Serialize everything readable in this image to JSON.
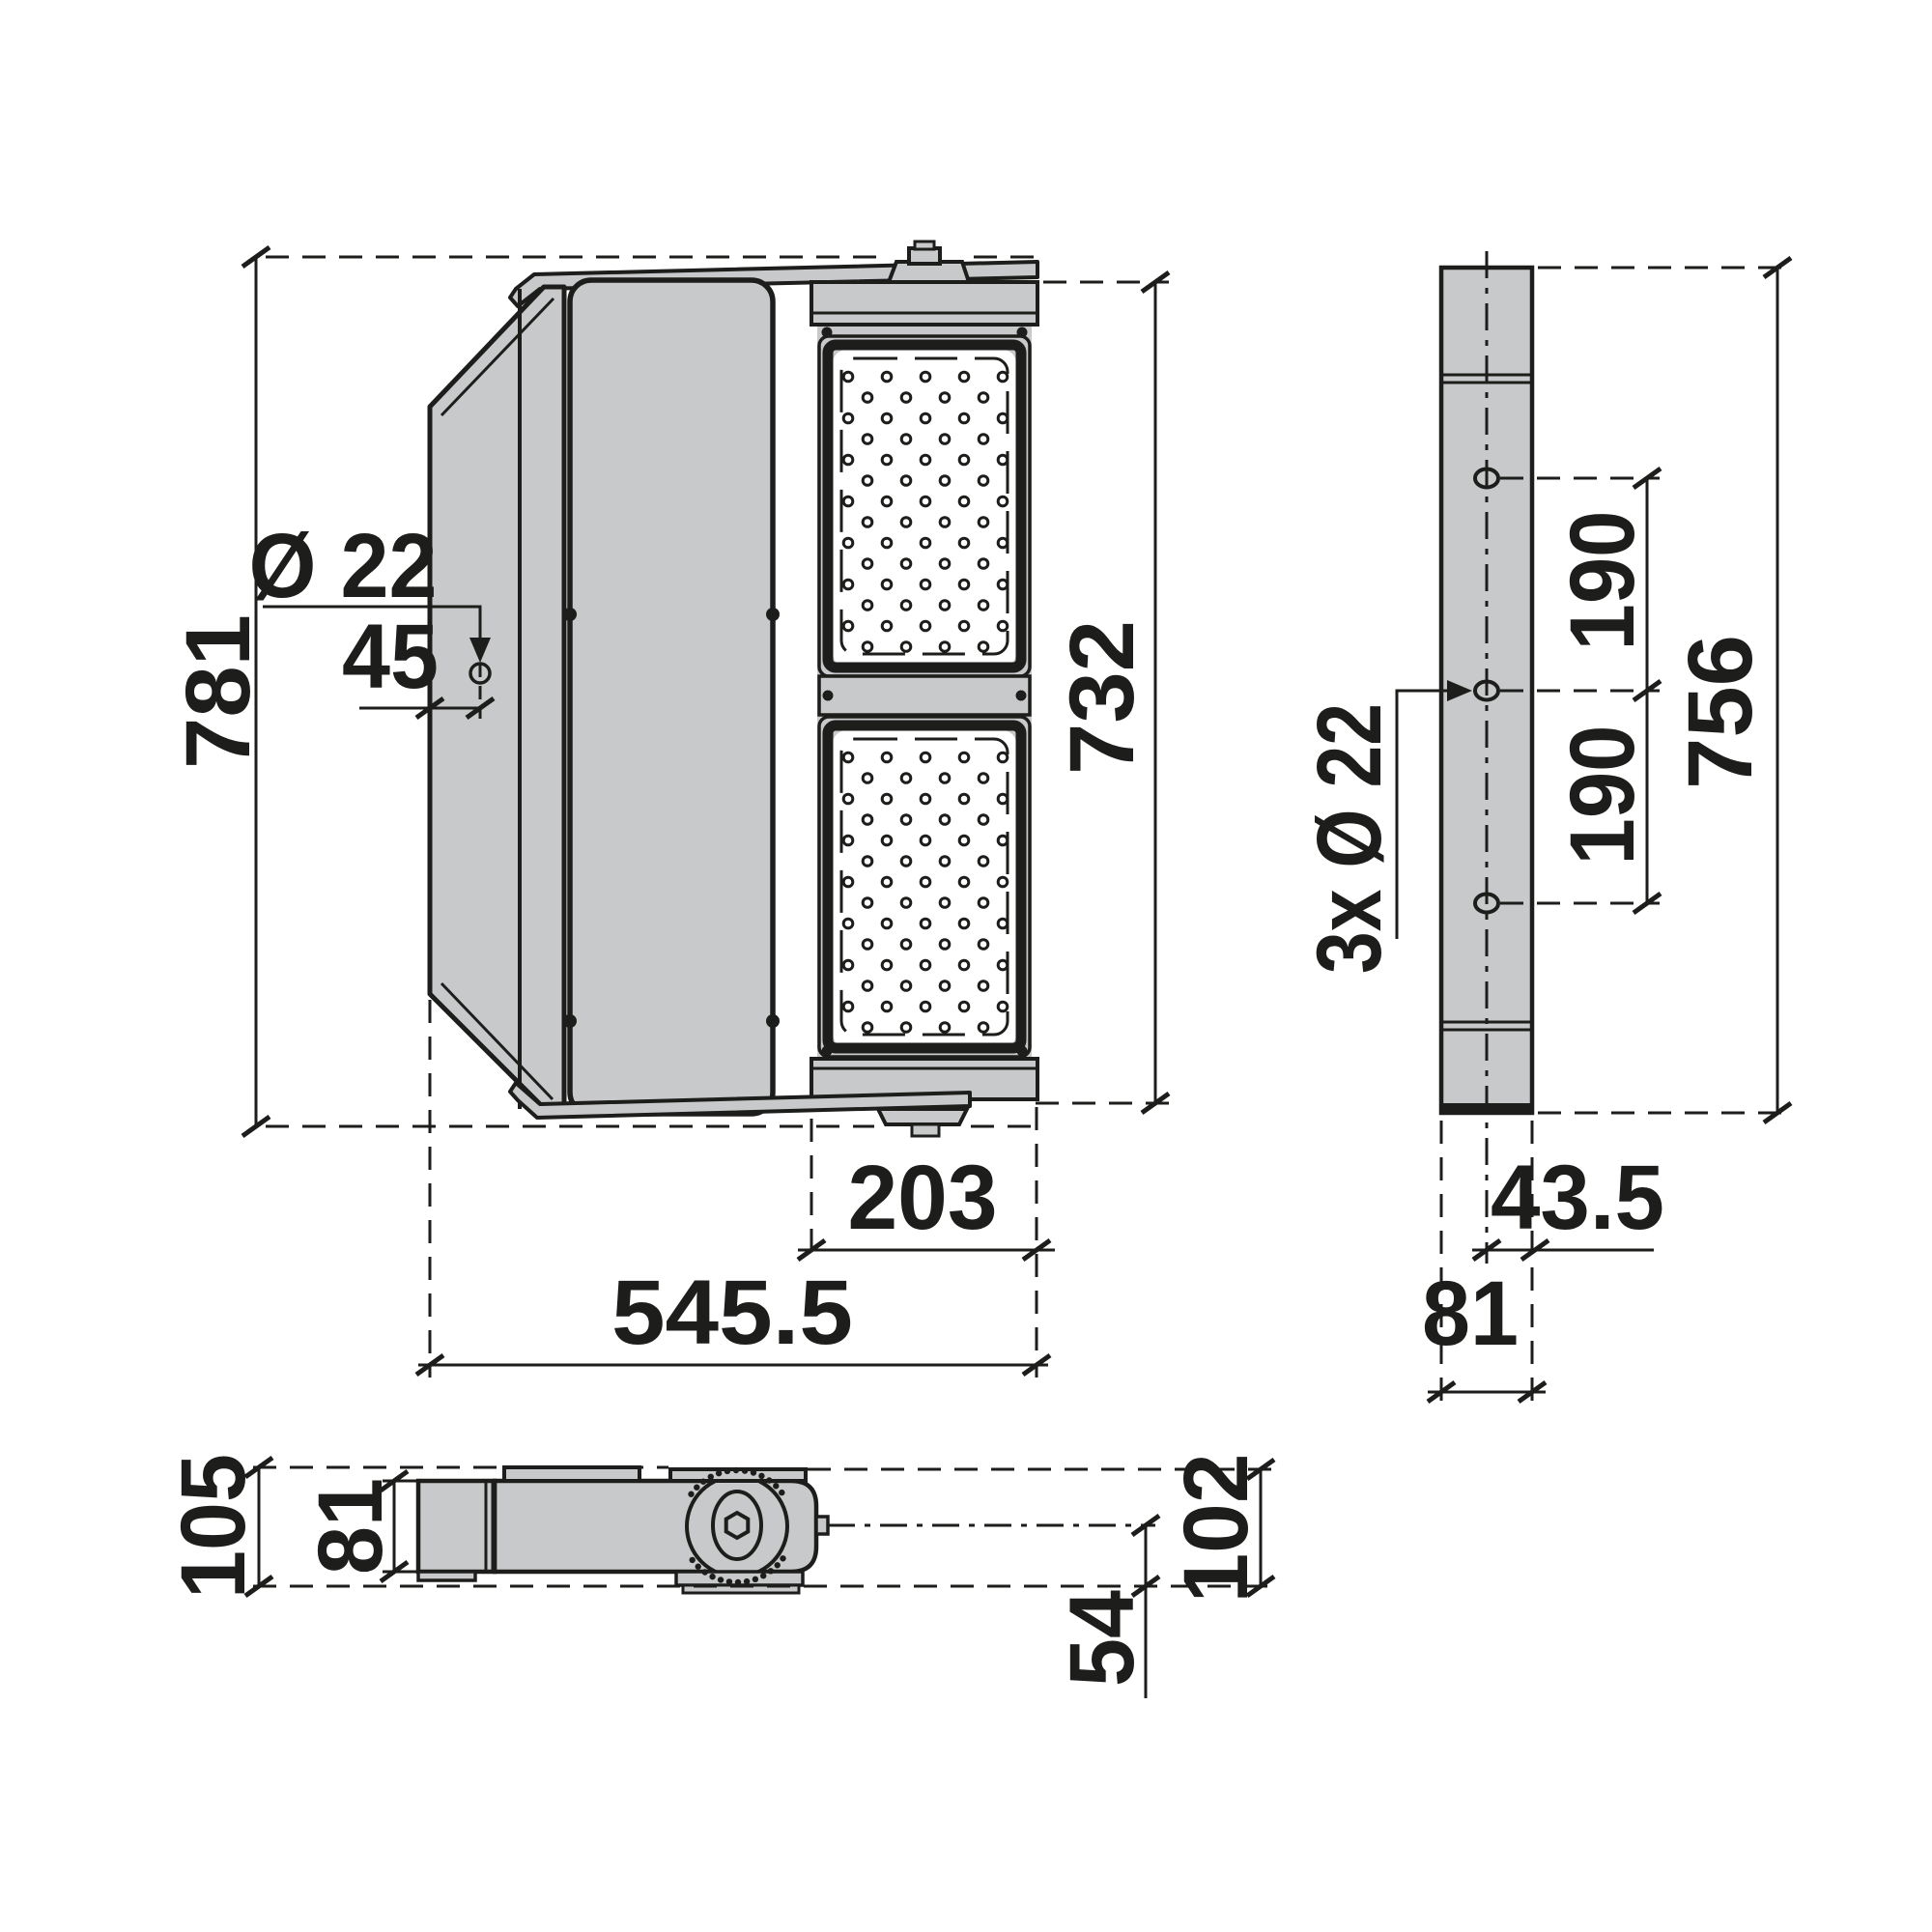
{
  "drawing": {
    "type": "luminaire-dimension-drawing",
    "front_view": {
      "overall_height": "781",
      "overall_width": "545.5",
      "hole_diameter": "Ø 22",
      "hole_offset": "45",
      "led_section_height": "732",
      "led_module_width": "203"
    },
    "side_view": {
      "overall_height": "756",
      "hole_spacing_upper": "190",
      "hole_spacing_lower": "190",
      "mounting_holes": "3x Ø 22",
      "center_to_edge": "43.5",
      "profile_width": "81"
    },
    "top_view": {
      "overall_depth": "105",
      "body_depth": "81",
      "bracket_height": "102",
      "pivot_offset": "54"
    }
  }
}
